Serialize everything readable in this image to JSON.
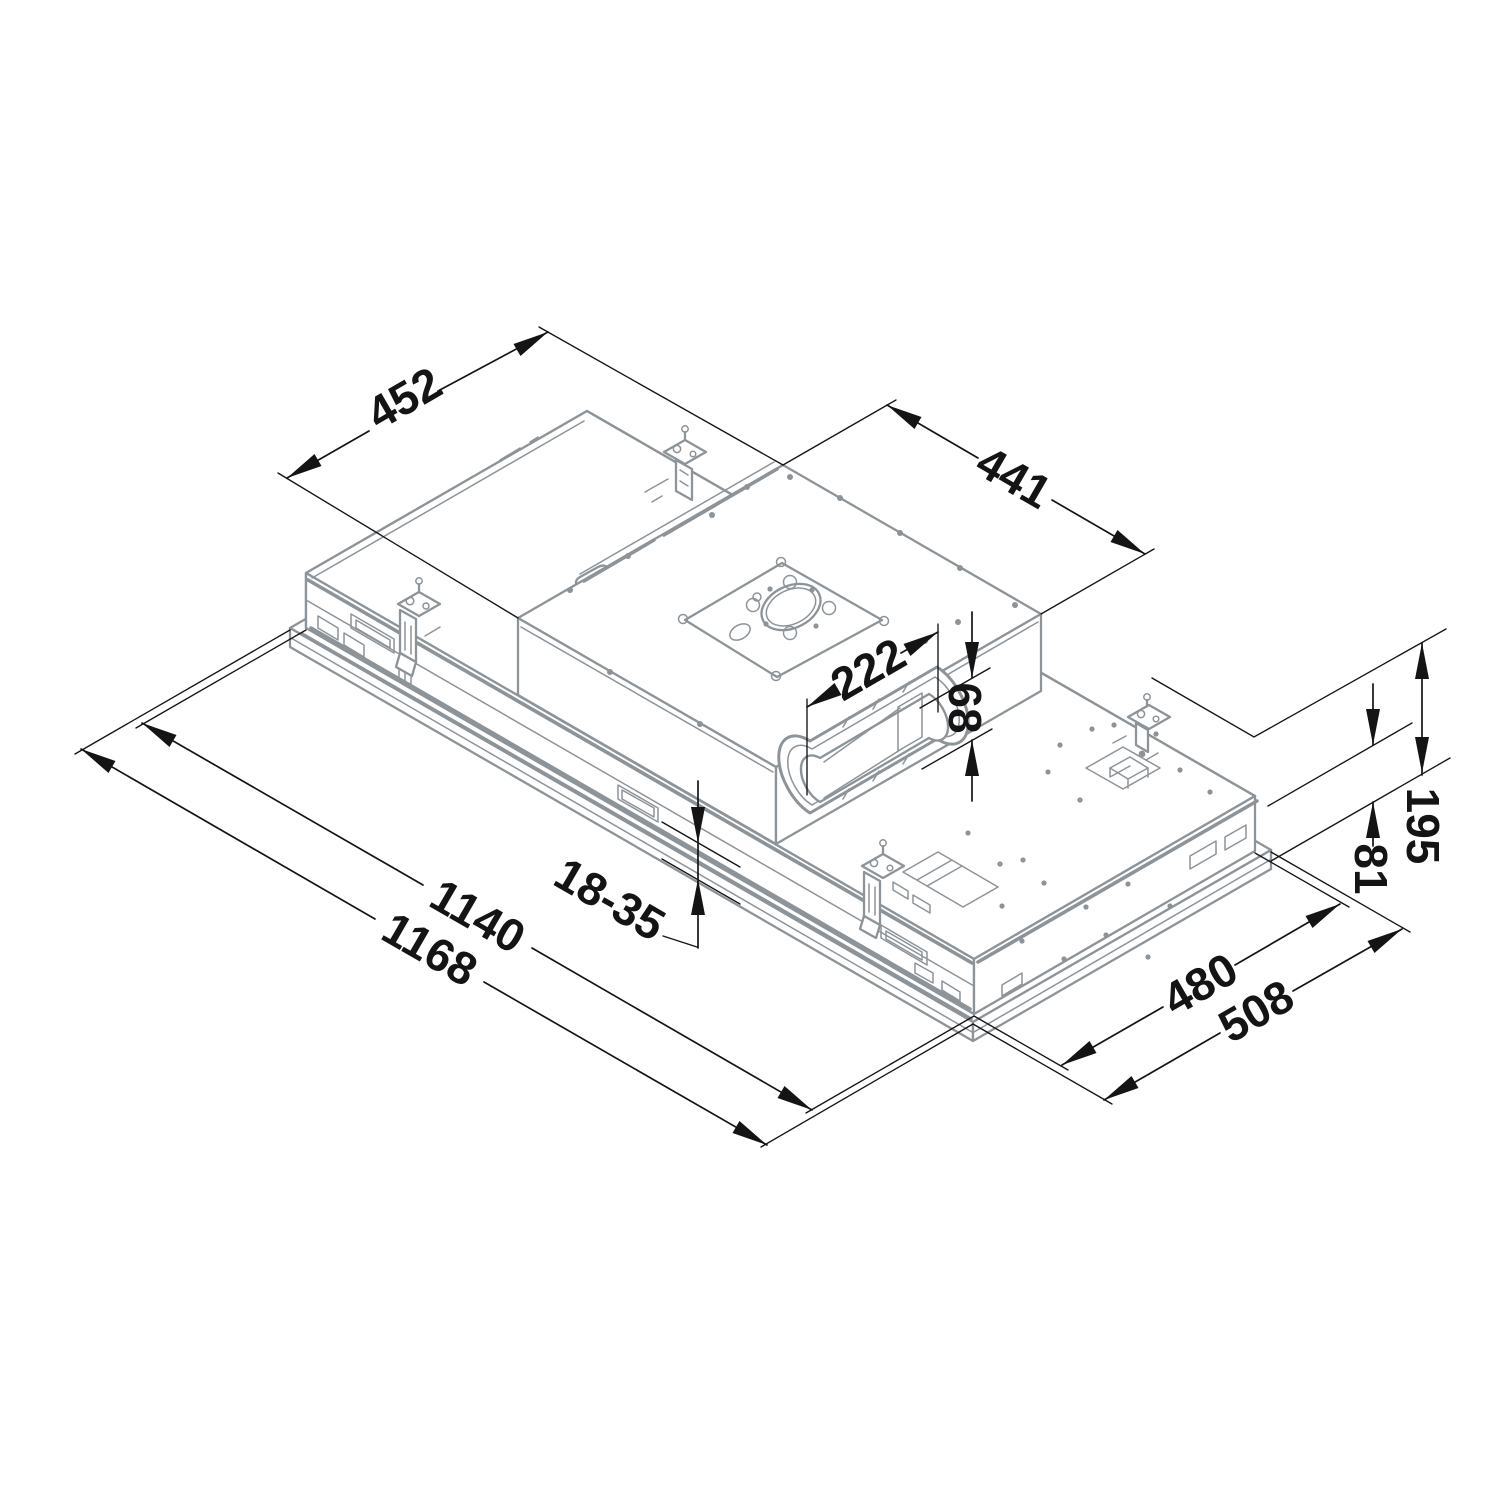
{
  "drawing": {
    "type": "isometric-dimension-diagram",
    "subject": "ceiling built-in cooker hood unit with motor box and flat duct outlet",
    "colors": {
      "background": "#ffffff",
      "unit_outline": "#8d9499",
      "dimension": "#141414"
    },
    "dimension_labels": {
      "box_depth": "452",
      "box_width": "441",
      "duct_width": "222",
      "duct_height": "68",
      "ceiling_thickness_range": "18-35",
      "body_length": "1140",
      "overall_length": "1168",
      "body_height": "81",
      "overall_height": "195",
      "body_depth": "480",
      "overall_depth": "508"
    }
  }
}
